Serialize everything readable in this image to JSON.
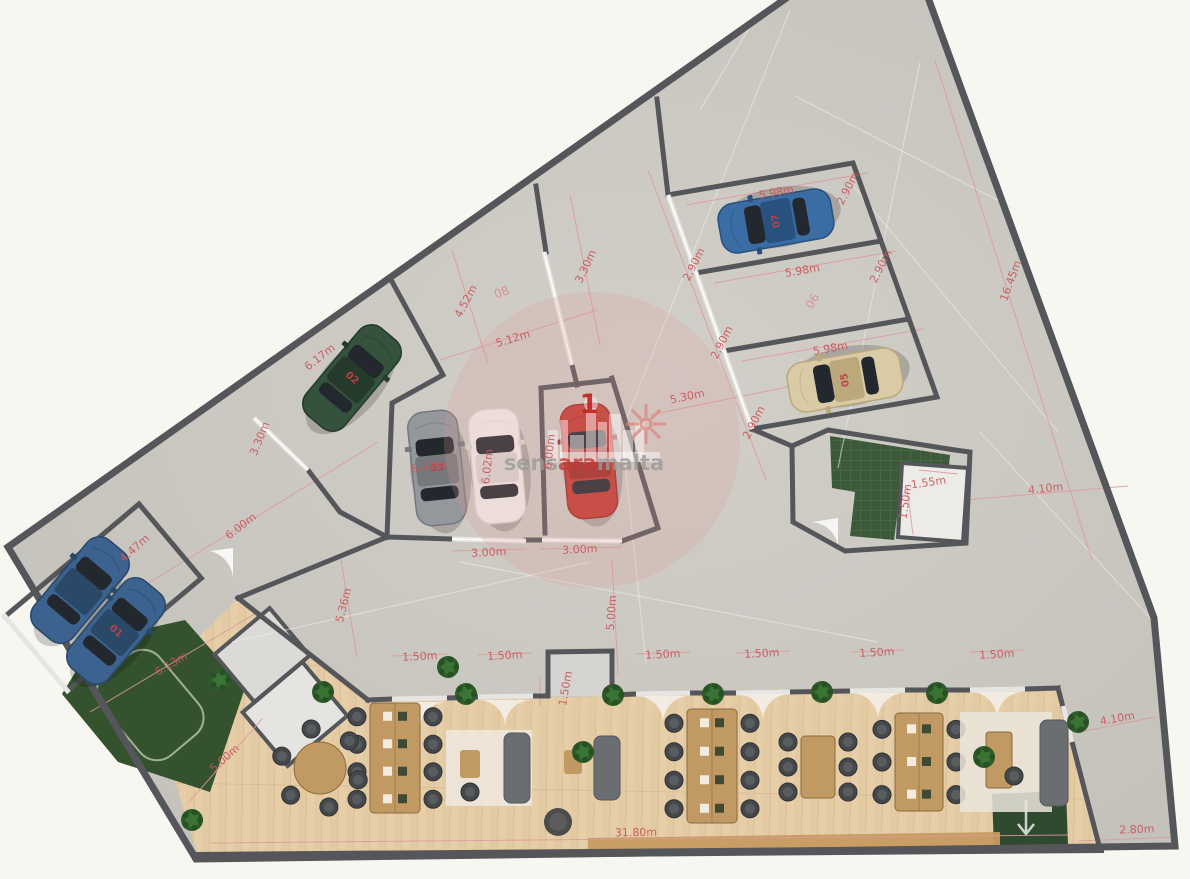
{
  "plan": {
    "type": "floor-plan",
    "watermark": {
      "part1": "sens",
      "part2": "ara",
      "part3": "malta"
    },
    "colors": {
      "page": "#f8f6f1",
      "concrete": "#cac7c1",
      "wall": "#54565a",
      "curb": "#e7e5e1",
      "wood": "#e6cfa8",
      "garden": "#35522e",
      "stair_green": "#3c5a39",
      "dim_red": "#c8575c",
      "area_red": "#d98a8e",
      "desk_tan": "#c09a62"
    },
    "marker": {
      "text": "1",
      "x": 589,
      "y": 413
    },
    "area_labels": [
      {
        "text": "08",
        "x": 503,
        "y": 296,
        "r": -20
      },
      {
        "text": "06",
        "x": 816,
        "y": 303,
        "r": -60
      }
    ],
    "dim_labels": [
      {
        "text": "6.17m",
        "x": 322,
        "y": 360,
        "r": -38
      },
      {
        "text": "3.30m",
        "x": 263,
        "y": 440,
        "r": -68
      },
      {
        "text": "4.52m",
        "x": 469,
        "y": 303,
        "r": -62
      },
      {
        "text": "5.12m",
        "x": 514,
        "y": 342,
        "r": -17
      },
      {
        "text": "3.30m",
        "x": 589,
        "y": 268,
        "r": -65
      },
      {
        "text": "5.98m",
        "x": 777,
        "y": 196,
        "r": -10
      },
      {
        "text": "2.90m",
        "x": 851,
        "y": 190,
        "r": -63
      },
      {
        "text": "2.90m",
        "x": 697,
        "y": 266,
        "r": -63
      },
      {
        "text": "5.98m",
        "x": 803,
        "y": 274,
        "r": -10
      },
      {
        "text": "2.90m",
        "x": 884,
        "y": 268,
        "r": -63
      },
      {
        "text": "2.90m",
        "x": 725,
        "y": 344,
        "r": -63
      },
      {
        "text": "5.98m",
        "x": 831,
        "y": 352,
        "r": -10
      },
      {
        "text": "2.90m",
        "x": 757,
        "y": 424,
        "r": -63
      },
      {
        "text": "5.30m",
        "x": 688,
        "y": 400,
        "r": -12
      },
      {
        "text": "16.45m",
        "x": 1014,
        "y": 282,
        "r": -70
      },
      {
        "text": "4.10m",
        "x": 1046,
        "y": 492,
        "r": -6
      },
      {
        "text": "1.55m",
        "x": 929,
        "y": 486,
        "r": -8
      },
      {
        "text": "1.50m",
        "x": 909,
        "y": 502,
        "r": -82
      },
      {
        "text": "6.47m",
        "x": 429,
        "y": 470,
        "r": -10
      },
      {
        "text": "6.02m",
        "x": 491,
        "y": 467,
        "r": -84
      },
      {
        "text": "6.00m",
        "x": 553,
        "y": 452,
        "r": -84
      },
      {
        "text": "3.00m",
        "x": 489,
        "y": 556,
        "r": -3
      },
      {
        "text": "3.00m",
        "x": 580,
        "y": 553,
        "r": -3
      },
      {
        "text": "5.00m",
        "x": 615,
        "y": 613,
        "r": -86
      },
      {
        "text": "5.36m",
        "x": 347,
        "y": 606,
        "r": -76
      },
      {
        "text": "6.00m",
        "x": 243,
        "y": 529,
        "r": -37
      },
      {
        "text": "4.47m",
        "x": 137,
        "y": 551,
        "r": -42
      },
      {
        "text": "6.13m",
        "x": 173,
        "y": 667,
        "r": -31
      },
      {
        "text": "5.00m",
        "x": 227,
        "y": 761,
        "r": -42
      },
      {
        "text": "1.50m",
        "x": 420,
        "y": 660,
        "r": -3
      },
      {
        "text": "1.50m",
        "x": 505,
        "y": 659,
        "r": -3
      },
      {
        "text": "1.50m",
        "x": 663,
        "y": 658,
        "r": -3
      },
      {
        "text": "1.50m",
        "x": 762,
        "y": 657,
        "r": -3
      },
      {
        "text": "1.50m",
        "x": 877,
        "y": 656,
        "r": -3
      },
      {
        "text": "1.50m",
        "x": 997,
        "y": 658,
        "r": -3
      },
      {
        "text": "1.50m",
        "x": 569,
        "y": 689,
        "r": -80
      },
      {
        "text": "31.80m",
        "x": 636,
        "y": 836,
        "r": -1
      },
      {
        "text": "4.10m",
        "x": 1118,
        "y": 722,
        "r": -10
      },
      {
        "text": "2.80m",
        "x": 1137,
        "y": 833,
        "r": -2
      }
    ],
    "cars": [
      {
        "num": "",
        "body": "#3c628f",
        "roof": "#2a4868",
        "x": 80,
        "y": 590,
        "r": 40
      },
      {
        "num": "01",
        "body": "#3c628f",
        "roof": "#2a4868",
        "x": 116,
        "y": 631,
        "r": 40
      },
      {
        "num": "02",
        "body": "#35523d",
        "roof": "#253a2b",
        "x": 352,
        "y": 378,
        "r": 40
      },
      {
        "num": "03",
        "body": "#94979b",
        "roof": "#75787c",
        "x": 437,
        "y": 468,
        "r": -6
      },
      {
        "num": "",
        "body": "#f1f0ed",
        "roof": "#d9d8d5",
        "x": 497,
        "y": 466,
        "r": -5
      },
      {
        "num": "04",
        "body": "#c23a32",
        "roof": "#9e2b24",
        "x": 589,
        "y": 461,
        "r": -5
      },
      {
        "num": "05",
        "body": "#d9cba5",
        "roof": "#bba97c",
        "x": 845,
        "y": 380,
        "r": -100
      },
      {
        "num": "07",
        "body": "#3a6da3",
        "roof": "#28517d",
        "x": 776,
        "y": 221,
        "r": -100
      }
    ],
    "plants": [
      [
        323,
        692
      ],
      [
        466,
        694
      ],
      [
        613,
        695
      ],
      [
        713,
        694
      ],
      [
        822,
        692
      ],
      [
        937,
        693
      ],
      [
        1078,
        722
      ],
      [
        192,
        820
      ],
      [
        448,
        667
      ],
      [
        220,
        680
      ],
      [
        984,
        757
      ],
      [
        583,
        752
      ]
    ],
    "dim_lines": [
      [
        440,
        360,
        597,
        310
      ],
      [
        452,
        250,
        488,
        363
      ],
      [
        570,
        195,
        600,
        345
      ],
      [
        648,
        170,
        737,
        404
      ],
      [
        686,
        205,
        868,
        173
      ],
      [
        714,
        283,
        896,
        251
      ],
      [
        742,
        361,
        924,
        329
      ],
      [
        935,
        60,
        1092,
        560
      ],
      [
        650,
        415,
        792,
        386
      ],
      [
        737,
        404,
        766,
        480
      ],
      [
        965,
        500,
        1128,
        486
      ],
      [
        108,
        608,
        378,
        442
      ],
      [
        90,
        712,
        258,
        612
      ],
      [
        341,
        560,
        357,
        657
      ],
      [
        612,
        560,
        618,
        674
      ],
      [
        452,
        551,
        526,
        549
      ],
      [
        540,
        549,
        622,
        547
      ],
      [
        210,
        843,
        1068,
        835
      ],
      [
        190,
        801,
        262,
        719
      ],
      [
        1085,
        731,
        1155,
        717
      ],
      [
        1078,
        841,
        1178,
        837
      ],
      [
        393,
        656,
        447,
        654
      ],
      [
        478,
        655,
        532,
        653
      ],
      [
        636,
        654,
        690,
        652
      ],
      [
        736,
        653,
        790,
        651
      ],
      [
        851,
        652,
        905,
        650
      ],
      [
        970,
        652,
        1024,
        650
      ],
      [
        919,
        470,
        958,
        474
      ],
      [
        907,
        487,
        913,
        535
      ],
      [
        540,
        676,
        540,
        706
      ]
    ],
    "seams": [
      [
        790,
        10,
        622,
        430
      ],
      [
        850,
        182,
        1058,
        432
      ],
      [
        920,
        62,
        838,
        468
      ],
      [
        460,
        562,
        878,
        642
      ],
      [
        232,
        642,
        590,
        562
      ],
      [
        622,
        434,
        646,
        664
      ],
      [
        795,
        96,
        1118,
        262
      ],
      [
        700,
        110,
        760,
        10
      ],
      [
        980,
        432,
        1152,
        620
      ]
    ]
  }
}
